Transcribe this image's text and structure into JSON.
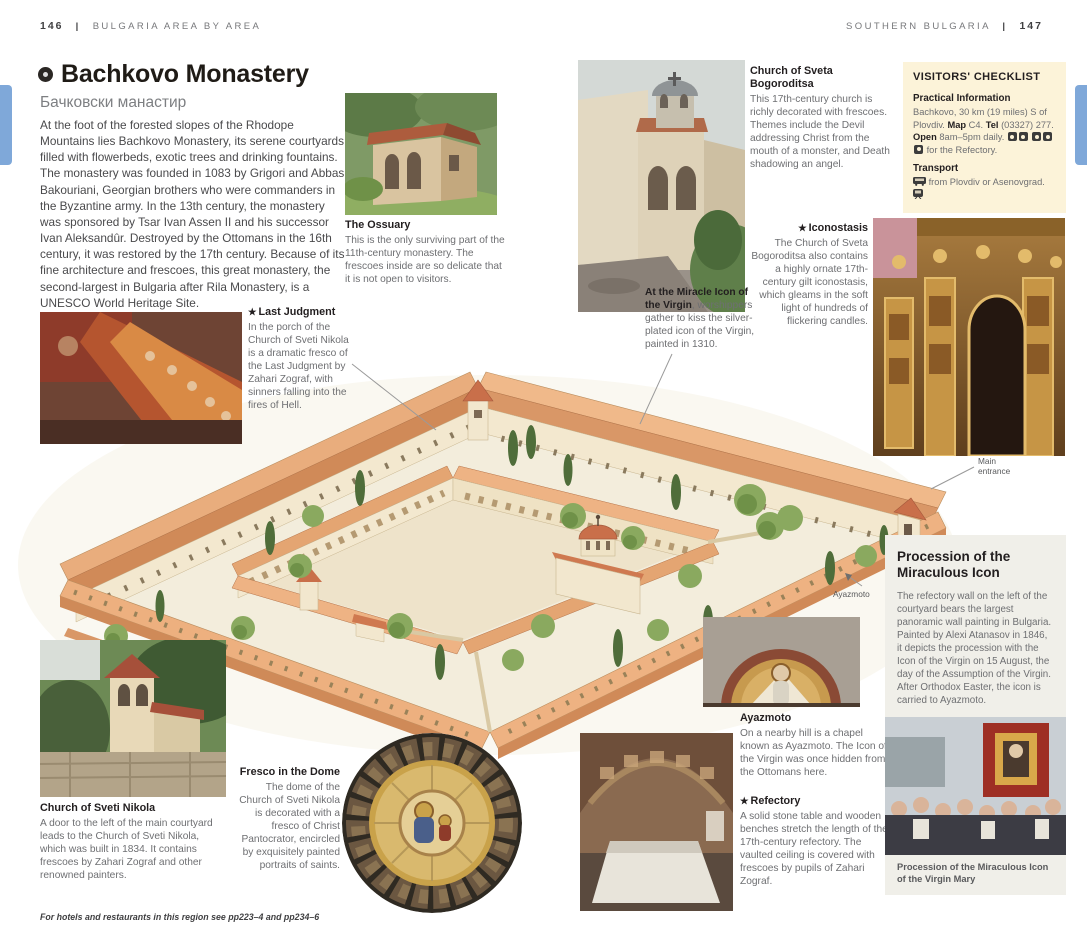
{
  "page": {
    "header_left": {
      "page_num": "146",
      "title": "BULGARIA AREA BY AREA"
    },
    "header_right": {
      "title": "SOUTHERN BULGARIA",
      "page_num": "147"
    },
    "footer": "For hotels and restaurants in this region see pp223–4 and pp234–6"
  },
  "article": {
    "title": "Bachkovo Monastery",
    "subtitle": "Бачковски манастир",
    "intro": "At the foot of the forested slopes of the Rhodope Mountains lies Bachkovo Monastery, its serene courtyards filled with flowerbeds, exotic trees and drinking fountains. The monastery was founded in 1083 by Grigori and Abbasi Bakouriani, Georgian brothers who were commanders in the Byzantine army. In the 13th century, the monastery was sponsored by Tsar Ivan Assen II and his successor Ivan Aleksandûr. Destroyed by the Ottomans in the 16th century, it was restored by the 17th century. Because of its fine architecture and frescoes, this great monastery, the second-largest in Bulgaria after Rila Monastery, is a UNESCO World Heritage Site."
  },
  "captions": {
    "ossuary": {
      "heading": "The Ossuary",
      "body": "This is the only surviving part of the 11th-century monastery. The frescoes inside are so delicate that it is not open to visitors."
    },
    "sveta_bogoroditsa": {
      "heading": "Church of Sveta Bogoroditsa",
      "body": "This 17th-century church is richly decorated with frescoes. Themes include the Devil addressing Christ from the mouth of a monster, and Death shadowing an angel."
    },
    "iconostasis": {
      "star": "★",
      "heading": "Iconostasis",
      "body": "The Church of Sveta Bogoroditsa also contains a highly ornate 17th-century gilt iconostasis, which gleams in the soft light of hundreds of flickering candles."
    },
    "miracle_icon": {
      "lead": "At the Miracle Icon of the Virgin",
      "body": ", worshippers gather to kiss the silver-plated icon of the Virgin, painted in 1310."
    },
    "last_judgment": {
      "star": "★",
      "heading": "Last Judgment",
      "body": "In the porch of the Church of Sveti Nikola is a dramatic fresco of the Last Judgment by Zahari Zograf, with sinners falling into the fires of Hell."
    },
    "sveti_nikola": {
      "heading": "Church of Sveti Nikola",
      "body": "A door to the left of the main courtyard leads to the Church of Sveti Nikola, which was built in 1834. It contains frescoes by Zahari Zograf and other renowned painters."
    },
    "fresco_dome": {
      "heading": "Fresco in the Dome",
      "body": "The dome of the Church of Sveti Nikola is decorated with a fresco of Christ Pantocrator, encircled by exquisitely painted portraits of saints."
    },
    "ayazmoto": {
      "heading": "Ayazmoto",
      "body": "On a nearby hill is a chapel known as Ayazmoto. The Icon of the Virgin was once hidden from the Ottomans here."
    },
    "refectory": {
      "star": "★",
      "heading": "Refectory",
      "body": "A solid stone table and wooden benches stretch the length of the 17th-century refectory. The vaulted ceiling is covered with frescoes by pupils of Zahari Zograf."
    }
  },
  "checklist": {
    "title": "VISITORS' CHECKLIST",
    "practical_heading": "Practical Information",
    "location": "Bachkovo, 30 km (19 miles) S of Plovdiv.",
    "map_label": "Map",
    "map_value": "C4.",
    "tel_label": "Tel",
    "tel_value": "(03327) 277.",
    "open_label": "Open",
    "open_value": "8am–5pm daily.",
    "refectory_note": "for the Refectory.",
    "transport_heading": "Transport",
    "transport_text": "from Plovdiv or Asenovgrad."
  },
  "sidebar_box": {
    "title": "Procession of the Miraculous Icon",
    "body": "The refectory wall on the left of the courtyard bears the largest panoramic wall painting in Bulgaria. Painted by Alexi Atanasov in 1846, it depicts the procession with the Icon of the Virgin on 15 August, the day of the Assumption of the Virgin. After Orthodox Easter, the icon is carried to Ayazmoto.",
    "photo_caption": "Procession of the Miraculous Icon of the Virgin Mary"
  },
  "labels": {
    "main_entrance": "Main entrance",
    "ayazmoto": "Ayazmoto"
  },
  "colors": {
    "accent_blue": "#7fa8d9",
    "checklist_bg": "#fcf3d9",
    "sidebar_bg": "#f0efe9"
  }
}
